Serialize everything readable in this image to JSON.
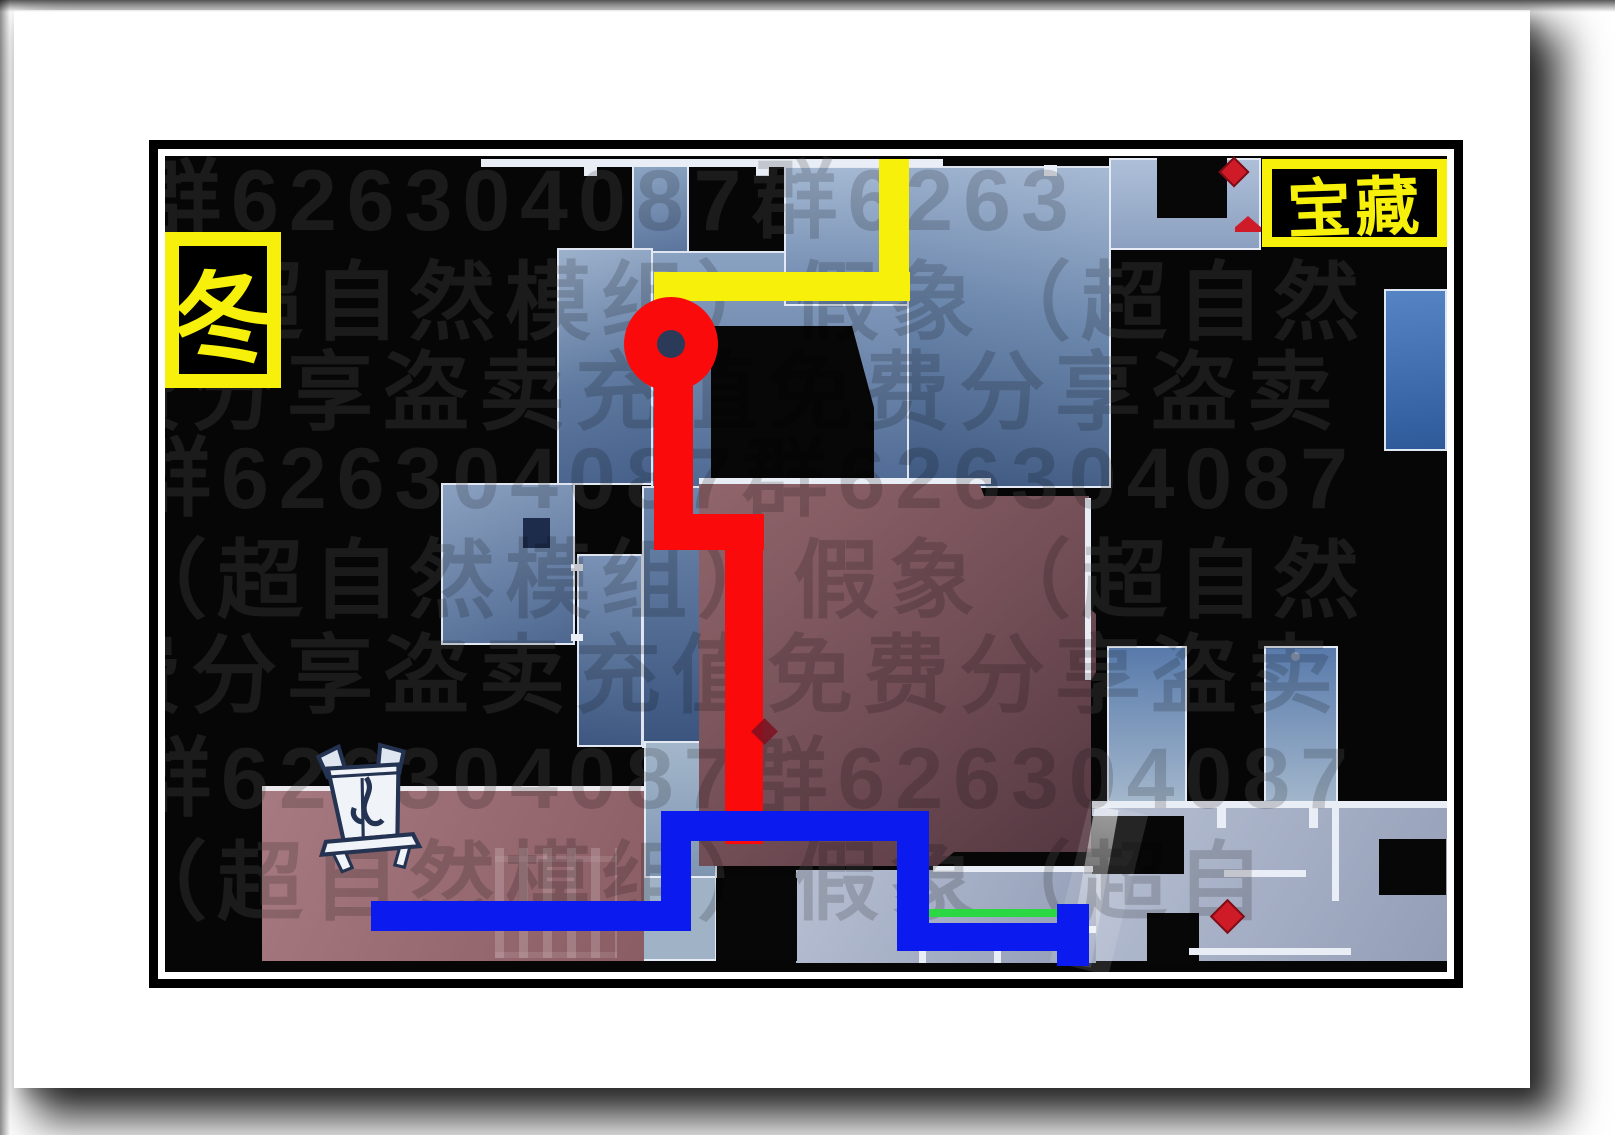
{
  "map": {
    "labels": {
      "season": "冬",
      "treasure": "宝藏"
    },
    "watermark": {
      "rows": [
        "群626304087群6263",
        "象（超自然模组）假象（超自然",
        "费分享盗卖充值免费分享盗卖",
        "群626304087群626304087",
        "象（超自然模组）假象（超自然",
        "费分享盗卖充值免费分享盗卖",
        "群626304087群626304087",
        "象（超自然模组）假象（超自"
      ]
    },
    "colors": {
      "route_yellow": "#f6f00a",
      "route_red": "#fa0a0a",
      "route_blue": "#0b1bf0",
      "route_green": "#2bd843",
      "label_yellow": "#f6f00a",
      "frame_black": "#000000",
      "room_blue": "#6e89ae",
      "room_maroon": "#744f57",
      "marker_red": "#cf1b27",
      "start_hole": "#2c3a5a"
    },
    "markers": {
      "start": "red-route-start",
      "treasure_diamonds": 4,
      "incense_burner": "censer-icon"
    }
  }
}
